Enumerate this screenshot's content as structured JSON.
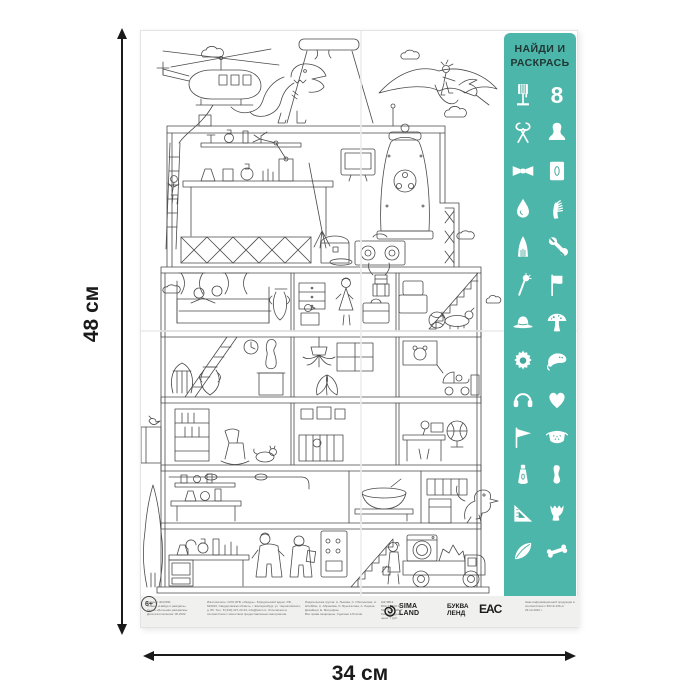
{
  "dimensions": {
    "height_label": "48 см",
    "width_label": "34 см"
  },
  "poster": {
    "title_panel": {
      "title": "НАЙДИ И\nРАСКРАСЬ",
      "bg_color": "#4db6ab",
      "icons": [
        {
          "name": "floor-lamp-icon"
        },
        {
          "name": "number-8-icon",
          "glyph": "8"
        },
        {
          "name": "pincers-icon"
        },
        {
          "name": "bust-icon"
        },
        {
          "name": "bow-tie-icon"
        },
        {
          "name": "mirror-frame-icon"
        },
        {
          "name": "water-drop-icon"
        },
        {
          "name": "comb-icon"
        },
        {
          "name": "cloak-icon"
        },
        {
          "name": "wrench-icon"
        },
        {
          "name": "torch-icon"
        },
        {
          "name": "flag-icon"
        },
        {
          "name": "hat-icon"
        },
        {
          "name": "mushroom-icon"
        },
        {
          "name": "gear-icon"
        },
        {
          "name": "stingray-icon"
        },
        {
          "name": "headphones-icon"
        },
        {
          "name": "heart-icon"
        },
        {
          "name": "pennant-icon"
        },
        {
          "name": "face-mask-icon"
        },
        {
          "name": "cream-tube-icon"
        },
        {
          "name": "shoehorn-icon"
        },
        {
          "name": "set-square-icon"
        },
        {
          "name": "vase-icon"
        },
        {
          "name": "feather-icon"
        },
        {
          "name": "bone-icon"
        }
      ]
    },
    "scene_elements": [
      "helicopter",
      "rope-ladder-scientist",
      "volcano",
      "t-rex",
      "pterodactyl-with-rider",
      "clouds",
      "six-story-house",
      "attic-laboratory",
      "bell-machine",
      "boombox",
      "chest",
      "bedroom",
      "knight-armor",
      "dog-on-stairs",
      "living-room-statue",
      "harp",
      "hanging-plant",
      "stroller",
      "globe",
      "kids-room",
      "kitchen",
      "ground-laboratory",
      "scientists",
      "truck-with-washing-machine",
      "raptor",
      "tree",
      "bird"
    ],
    "footer": {
      "credits_col1": "Артикул 4013931\nПлакат «Найди и раскрась»\nСерия «Большая раскраска»\nДата изготовления: 06.2022",
      "credits_col2": "Изготовитель: ООО ИПК «Лазурь». Юридический адрес: РФ, 620010, Свердловская область, г. Екатеринбург, ул. Черняховского, д. 86. Тел.: 8 (343) 227-23-23, info@lazur.ru. Отпечатано в соответствии с качеством предоставленных материалов.",
      "credits_col3": "Издательская группа: А. Лыкова, С. Оболенская, А. Штейбах, А. Абрамова, О. Брызгалова, А. Ларина. Дизайнер: Е. Митрофан.\nВсе права защищены. Сделано в России.",
      "credits_col4": "ШК 9В13\nБЗА 74-100-37\n№ ТС 267-2017\nРекомендуемая цена: 7 руб.",
      "logos": {
        "sima_line1": "SIMA",
        "sima_line2": "LAND",
        "bukva_line1": "БУКВА",
        "bukva_line2": "ЛЕНД",
        "eac": "EAC",
        "age_rating": "6+",
        "age_note": "Знак информационной продукции в соответствии с ФЗ № 436 от 29.12.2010 г."
      }
    }
  }
}
